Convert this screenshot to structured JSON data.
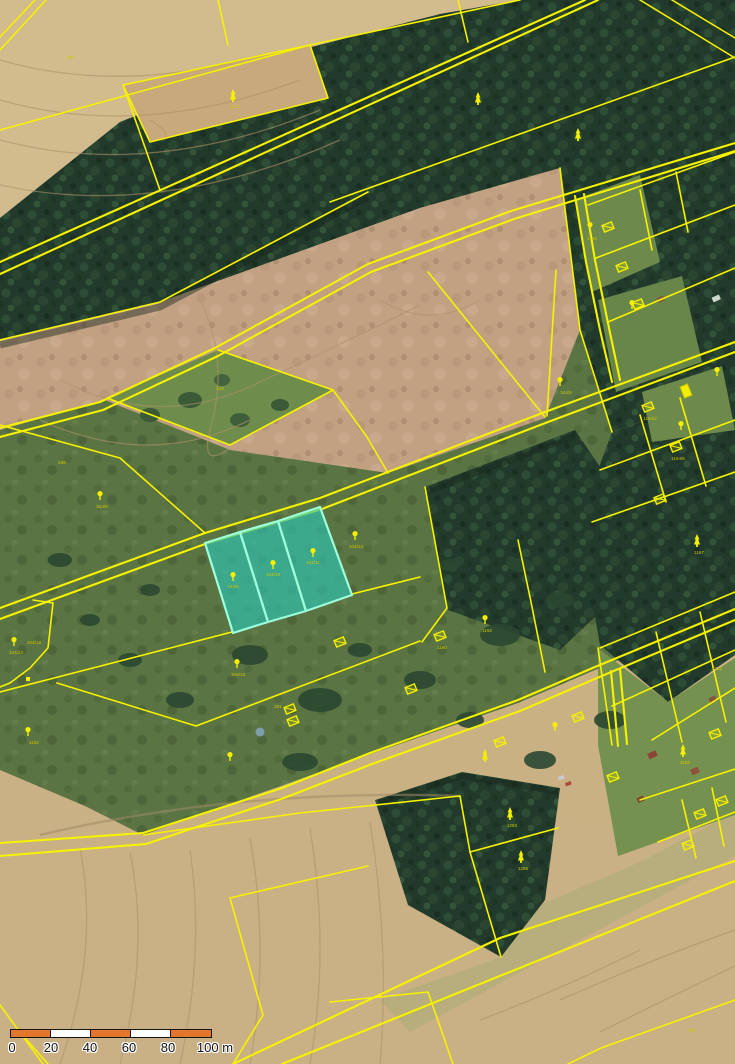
{
  "map": {
    "kind": "cadastral-parcel-overlay-on-orthophoto",
    "colors": {
      "parcel_line": "#f6f200",
      "highlight_fill": "#2ec4b2",
      "highlight_stroke": "#9dffdb",
      "scalebar_orange": "#e2762d",
      "scalebar_white": "#ffffff"
    },
    "highlighted_parcels": [
      {
        "label": "344/9"
      },
      {
        "label": "344/10"
      },
      {
        "label": "344/11"
      }
    ],
    "labels": [
      {
        "t": "344/9",
        "x": 233,
        "y": 588
      },
      {
        "t": "344/10",
        "x": 273,
        "y": 576
      },
      {
        "t": "344/11",
        "x": 313,
        "y": 564
      },
      {
        "t": "344/12",
        "x": 356,
        "y": 548
      },
      {
        "t": "344/8",
        "x": 102,
        "y": 508
      },
      {
        "t": "344/16",
        "x": 34,
        "y": 644
      },
      {
        "t": "344/22",
        "x": 16,
        "y": 654
      },
      {
        "t": "344/13",
        "x": 238,
        "y": 676
      },
      {
        "t": "343",
        "x": 220,
        "y": 390
      },
      {
        "t": "636",
        "x": 62,
        "y": 464
      },
      {
        "t": "930",
        "x": 70,
        "y": 59
      },
      {
        "t": "1147",
        "x": 235,
        "y": 108
      },
      {
        "t": "1162",
        "x": 487,
        "y": 632
      },
      {
        "t": "1167",
        "x": 699,
        "y": 554
      },
      {
        "t": "1163",
        "x": 685,
        "y": 764
      },
      {
        "t": "1252",
        "x": 717,
        "y": 670
      },
      {
        "t": "1283",
        "x": 512,
        "y": 827
      },
      {
        "t": "1285",
        "x": 523,
        "y": 870
      },
      {
        "t": "1182",
        "x": 592,
        "y": 240
      },
      {
        "t": "1164/2",
        "x": 650,
        "y": 420
      },
      {
        "t": "1164/6",
        "x": 678,
        "y": 460
      },
      {
        "t": "301",
        "x": 278,
        "y": 708
      },
      {
        "t": "1192",
        "x": 34,
        "y": 744
      },
      {
        "t": "687",
        "x": 692,
        "y": 1032
      },
      {
        "t": "344/5",
        "x": 566,
        "y": 394
      },
      {
        "t": "1160",
        "x": 442,
        "y": 649
      }
    ],
    "symbols": [
      {
        "k": "conifer",
        "x": 233,
        "y": 96
      },
      {
        "k": "conifer",
        "x": 478,
        "y": 99
      },
      {
        "k": "conifer",
        "x": 578,
        "y": 135
      },
      {
        "k": "conifer",
        "x": 697,
        "y": 541
      },
      {
        "k": "conifer",
        "x": 510,
        "y": 814
      },
      {
        "k": "conifer",
        "x": 521,
        "y": 857
      },
      {
        "k": "conifer",
        "x": 485,
        "y": 756
      },
      {
        "k": "conifer",
        "x": 683,
        "y": 751
      },
      {
        "k": "deciduous",
        "x": 233,
        "y": 577
      },
      {
        "k": "deciduous",
        "x": 273,
        "y": 565
      },
      {
        "k": "deciduous",
        "x": 313,
        "y": 553
      },
      {
        "k": "deciduous",
        "x": 355,
        "y": 536
      },
      {
        "k": "deciduous",
        "x": 237,
        "y": 664
      },
      {
        "k": "deciduous",
        "x": 230,
        "y": 757
      },
      {
        "k": "deciduous",
        "x": 485,
        "y": 620
      },
      {
        "k": "deciduous",
        "x": 555,
        "y": 727
      },
      {
        "k": "deciduous",
        "x": 28,
        "y": 732
      },
      {
        "k": "deciduous",
        "x": 14,
        "y": 642
      },
      {
        "k": "deciduous",
        "x": 590,
        "y": 227
      },
      {
        "k": "deciduous",
        "x": 632,
        "y": 305
      },
      {
        "k": "deciduous",
        "x": 681,
        "y": 426
      },
      {
        "k": "deciduous",
        "x": 717,
        "y": 372
      },
      {
        "k": "deciduous",
        "x": 100,
        "y": 496
      },
      {
        "k": "deciduous",
        "x": 560,
        "y": 382
      },
      {
        "k": "building",
        "x": 340,
        "y": 642
      },
      {
        "k": "building",
        "x": 290,
        "y": 709
      },
      {
        "k": "building",
        "x": 293,
        "y": 721
      },
      {
        "k": "building",
        "x": 440,
        "y": 636
      },
      {
        "k": "building",
        "x": 411,
        "y": 689
      },
      {
        "k": "building",
        "x": 500,
        "y": 742
      },
      {
        "k": "building",
        "x": 578,
        "y": 717
      },
      {
        "k": "building",
        "x": 613,
        "y": 777
      },
      {
        "k": "building",
        "x": 715,
        "y": 734
      },
      {
        "k": "building",
        "x": 648,
        "y": 407
      },
      {
        "k": "building",
        "x": 676,
        "y": 447
      },
      {
        "k": "building",
        "x": 660,
        "y": 499
      },
      {
        "k": "building",
        "x": 608,
        "y": 227
      },
      {
        "k": "building",
        "x": 622,
        "y": 267
      },
      {
        "k": "building",
        "x": 638,
        "y": 304
      },
      {
        "k": "building",
        "x": 700,
        "y": 814
      },
      {
        "k": "building",
        "x": 722,
        "y": 801
      },
      {
        "k": "building",
        "x": 688,
        "y": 845
      },
      {
        "k": "building-solid",
        "x": 686,
        "y": 391
      },
      {
        "k": "marker",
        "x": 28,
        "y": 679
      }
    ]
  },
  "scalebar": {
    "segments": [
      "#e2762d",
      "#ffffff",
      "#e2762d",
      "#ffffff",
      "#e2762d"
    ],
    "ticks": [
      {
        "t": "0",
        "x": 12
      },
      {
        "t": "20",
        "x": 51
      },
      {
        "t": "40",
        "x": 90
      },
      {
        "t": "60",
        "x": 129
      },
      {
        "t": "80",
        "x": 168
      },
      {
        "t": "100 m",
        "x": 215
      }
    ]
  }
}
